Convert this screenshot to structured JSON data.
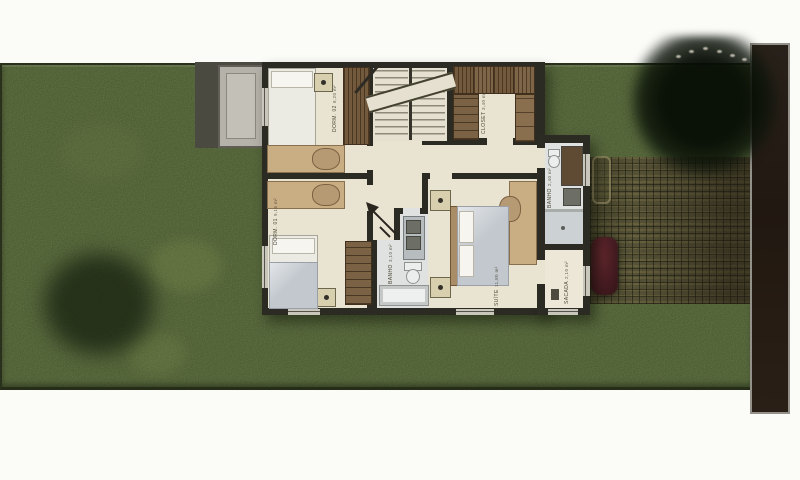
{
  "scene": {
    "title": "Pavimento Superior",
    "description": "Scanned upper-floor plan of a small house on a grass lot with terrace slab, paver driveway, parked car and street strip"
  },
  "rooms": [
    {
      "id": "dorm2",
      "name": "DORM. 02",
      "area": "8,20 m²"
    },
    {
      "id": "closet",
      "name": "CLOSET",
      "area": "3,40 m²"
    },
    {
      "id": "dorm1",
      "name": "DORM. 01",
      "area": "9,15 m²"
    },
    {
      "id": "suite",
      "name": "SUÍTE",
      "area": "11,80 m²"
    },
    {
      "id": "bath_social",
      "name": "BANHO",
      "area": "3,10 m²"
    },
    {
      "id": "bath_suite",
      "name": "BANHO",
      "area": "2,40 m²"
    },
    {
      "id": "sacada",
      "name": "SACADA",
      "area": "2,10 m²"
    }
  ],
  "site": {
    "lawn_color": "#43502e",
    "street_color": "#241b15",
    "paver_color": "#45422c",
    "wall_color": "#2c2b23",
    "floor_color": "#e9e4d2",
    "car_color": "#4f2127",
    "terrace_color": "#b5b2a9"
  },
  "icons": {
    "entry_arrow": "arrow pointing to stair hall (access indicator)",
    "ceiling_light": "square fixture with center dot"
  }
}
